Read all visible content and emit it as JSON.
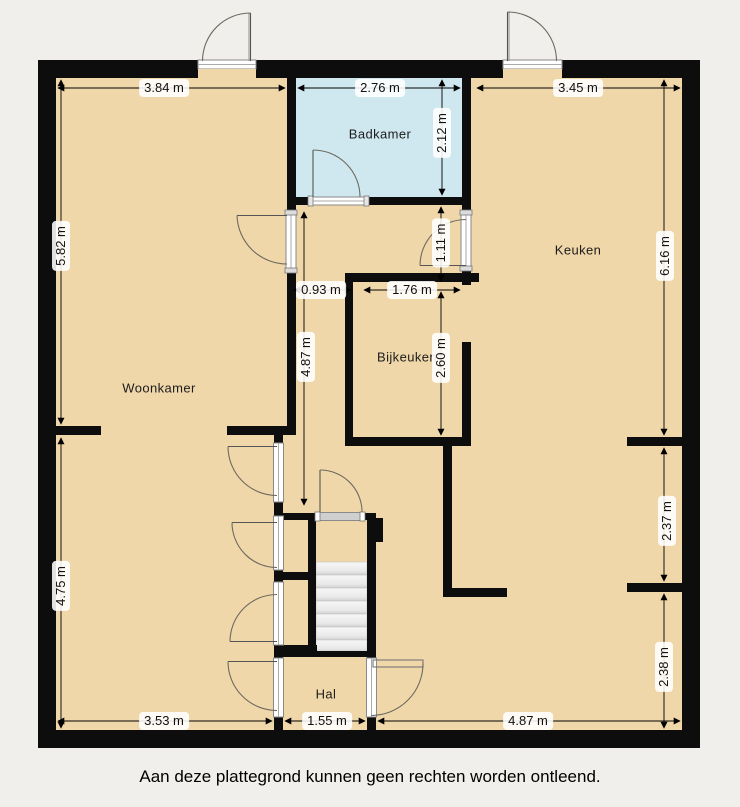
{
  "plan": {
    "rooms": {
      "woonkamer": {
        "label": "Woonkamer"
      },
      "badkamer": {
        "label": "Badkamer"
      },
      "keuken": {
        "label": "Keuken"
      },
      "bijkeuken": {
        "label": "Bijkeuken"
      },
      "hal": {
        "label": "Hal"
      }
    },
    "dimensions": {
      "top_left": "3.84 m",
      "badkamer_width": "2.76 m",
      "top_right": "3.45 m",
      "badkamer_height": "2.12 m",
      "left_upper": "5.82 m",
      "left_lower": "4.75 m",
      "keuken_height": "6.16 m",
      "keuken_door": "1.11 m",
      "corridor_width": "0.93 m",
      "bijkeuken_width": "1.76 m",
      "bijkeuken_height": "2.60 m",
      "corridor_height": "4.87 m",
      "right_middle": "2.37 m",
      "right_lower": "2.38 m",
      "bottom_left": "3.53 m",
      "hal_width": "1.55 m",
      "bottom_right": "4.87 m"
    },
    "colors": {
      "background": "#f0efeb",
      "floor": "#f0d7a9",
      "bathroom_floor": "#cfe8ef",
      "wall": "#0d0d0d",
      "stairs": "#e9e9e9"
    }
  },
  "footer": {
    "disclaimer": "Aan deze plattegrond kunnen geen rechten worden ontleend."
  }
}
